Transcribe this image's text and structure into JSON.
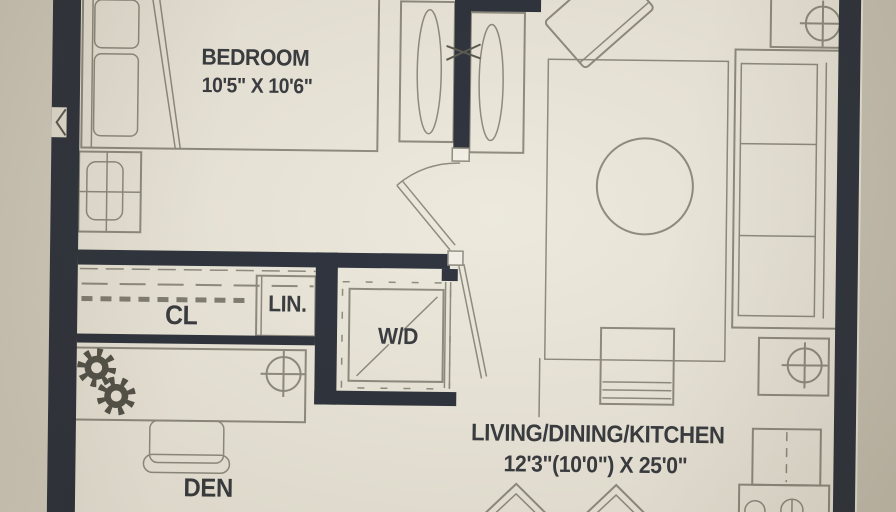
{
  "title": "apartment-floor-plan",
  "colors": {
    "wall": "#252b37",
    "floor": "#ece8dc",
    "outside": "#d7d1c3",
    "outside2": "#cbc5b6",
    "line": "#8b887c",
    "linedark": "#55544c",
    "text": "#31343a"
  },
  "rooms": {
    "bedroom": {
      "name": "BEDROOM",
      "dims": "10'5\" X 10'6\""
    },
    "closet": {
      "name": "CL"
    },
    "linen": {
      "name": "LIN."
    },
    "laundry": {
      "name": "W/D"
    },
    "living": {
      "name": "LIVING/DINING/KITCHEN",
      "dims": "12'3\"(10'0\") X 25'0\""
    },
    "den": {
      "name": "DEN"
    }
  }
}
